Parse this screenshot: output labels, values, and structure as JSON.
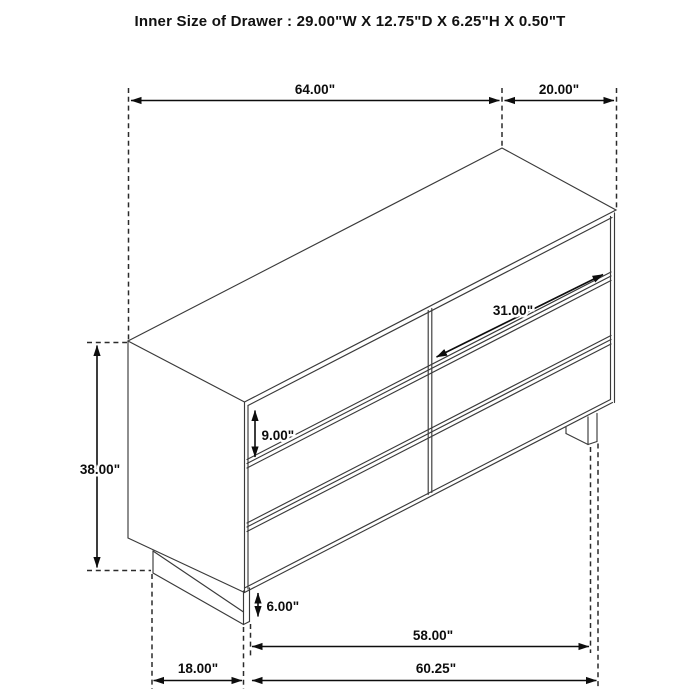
{
  "title": "Inner Size of Drawer : 29.00\"W X 12.75\"D X 6.25\"H X 0.50\"T",
  "dimensions": {
    "top_width": "64.00\"",
    "top_depth": "20.00\"",
    "drawer_face_width": "31.00\"",
    "drawer_face_height": "9.00\"",
    "overall_height": "38.00\"",
    "base_height": "6.00\"",
    "leg_span_width": "58.00\"",
    "overall_bottom_width": "60.25\"",
    "bottom_depth": "18.00\""
  },
  "colors": {
    "background": "#ffffff",
    "drawing_line": "#3a3a3a",
    "dimension_line": "#0d0d0d",
    "label_text": "#0d0d0d"
  }
}
